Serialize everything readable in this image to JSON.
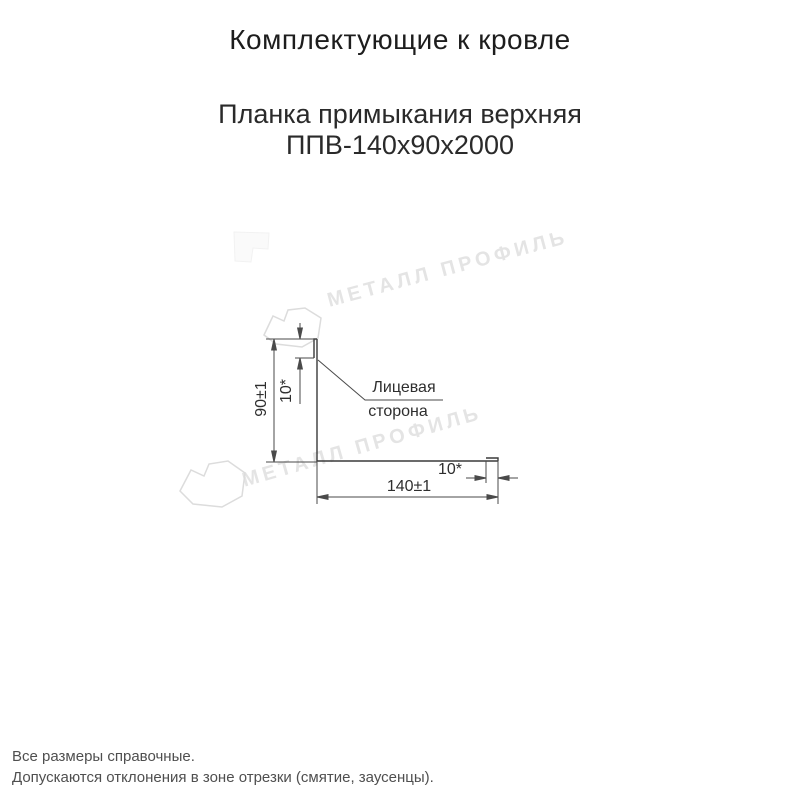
{
  "page": {
    "title": "Комплектующие к кровле",
    "product_title_line1": "Планка примыкания верхняя",
    "product_title_line2": "ППВ-140х90х2000",
    "notes": [
      "Все размеры справочные.",
      "Допускаются отклонения в зоне отрезки (смятие, заусенцы)."
    ]
  },
  "drawing": {
    "dim_height": "90±1",
    "dim_top_hem": "10*",
    "dim_width": "140±1",
    "dim_end_hem": "10*",
    "face_label_line1": "Лицевая",
    "face_label_line2": "сторона"
  },
  "watermark": {
    "text": "МЕТАЛЛ ПРОФИЛЬ",
    "color": "#e4e4e4"
  },
  "colors": {
    "profile_line": "#3a3a3a",
    "dimension_line": "#4a4a4a",
    "watermark_outline": "#dcdcdc"
  }
}
